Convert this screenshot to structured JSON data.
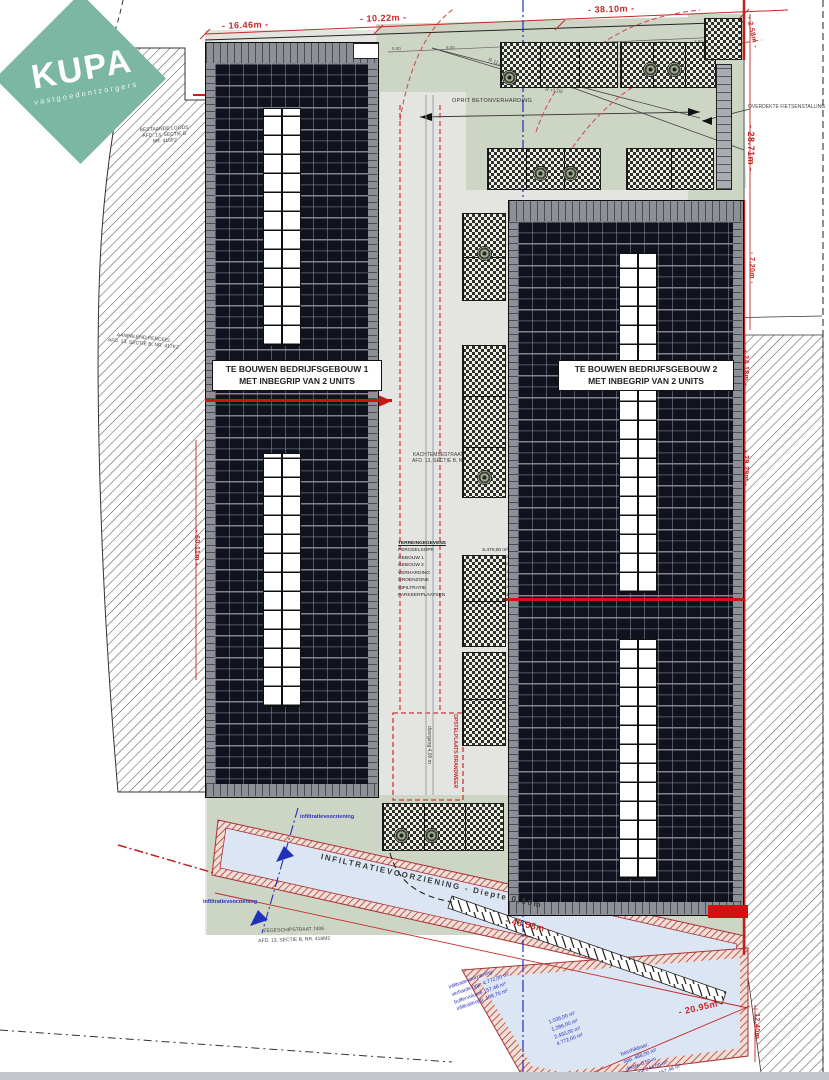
{
  "logo": {
    "brand": "KUPA",
    "tagline": "vastgoedontzorgers"
  },
  "buildings": [
    {
      "line1": "TE BOUWEN BEDRIJFSGEBOUW 1",
      "line2": "MET INBEGRIP VAN 2 UNITS"
    },
    {
      "line1": "TE BOUWEN BEDRIJFSGEBOUW 2",
      "line2": "MET INBEGRIP VAN 2 UNITS"
    }
  ],
  "dimensions": {
    "top_left": "- 16.46m -",
    "top_mid": "- 10.22m -",
    "top_right": "- 38.10m -",
    "right_a": "- 2.58m -",
    "right_b": "- 28.71m -",
    "right_c": "- 7.20m -",
    "right_d": "- 24.18m -",
    "right_e": "- 29.29m -",
    "left_side": "- 60.11m -",
    "bottom_a": "- 48.58m -",
    "bottom_b": "- 20.95m -",
    "bottom_c": "- 12.40m -",
    "ticks": [
      "5.00",
      "6.00",
      "8.50",
      "2.50",
      "2.50",
      "2.50",
      "2.50",
      "2.50",
      "5.40"
    ],
    "radius_a": "R 11,00",
    "radius_b": "R +1,00"
  },
  "annotations": {
    "oprit": "OPRIT BETONVERHARDING",
    "fietsen": "OVERDEKTE FIETSENSTALLING",
    "infiltratie": "INFILTRATIEVOORZIENING  -  Diepte 0,50m",
    "infiltratie_blue": "infiltratievoorziening",
    "brandweer": "OPSTELPLAATS BRANDWEER",
    "doorgang": "doorgang 4,00 m"
  },
  "parcels": {
    "top_left": [
      "BESTAANDE LOODS",
      "AFD. 13, SECTIE B",
      "NR. 416F2"
    ],
    "mid_left": [
      "AANPALEND PERCEEL",
      "AFD. 13, SECTIE B, NR. 417K2"
    ],
    "center": [
      "KACHTEMSESTRAAT Z/N (76)",
      "AFD. 13, SECTIE B, NR. 419M2"
    ],
    "bottom": [
      "ZEGESCHIPSTRAAT 7406",
      "AFD. 13, SECTIE B, NR. 418M2"
    ]
  },
  "legend": {
    "title": "TERREINGEGEVENS",
    "rows": [
      [
        "PERCEELSOPP.",
        "6.470,00 m²"
      ],
      [
        "GEBOUW 1",
        "1.036,00 m²"
      ],
      [
        "GEBOUW 2",
        "1.286,00 m²"
      ],
      [
        "VERHARDING",
        "2.450,00 m²"
      ],
      [
        "GROENZONE",
        "1.210,00 m²"
      ],
      [
        "INFILTRATIE",
        "488,00 m²"
      ],
      [
        "PARKEERPLAATSEN",
        "23 st"
      ]
    ]
  },
  "calc_notes": {
    "c1": [
      "infiltratievoorziening:",
      "verharde opp. 4.772,00 m²",
      "buffervolume 157,48 m³",
      "infiltratieopp. 108,76 m²"
    ],
    "c2": [
      "1.036,00 m²",
      "1.286,00 m²",
      "2.450,00 m²",
      "4.772,00 m²"
    ],
    "c3": [
      "beschikbaar:",
      "opp. 488,00 m²",
      "diepte 0,50 m",
      "volume 244,00 m³",
      "244,00 m³ > 157,48 m³"
    ]
  },
  "colors": {
    "brand_teal": "#7cb7a3",
    "dim_red": "#c62828",
    "roof_dark": "#10131d",
    "grass_green": "#cdd6c5",
    "basin_blue": "#dbe5f3",
    "note_blue": "#2b30b6"
  }
}
